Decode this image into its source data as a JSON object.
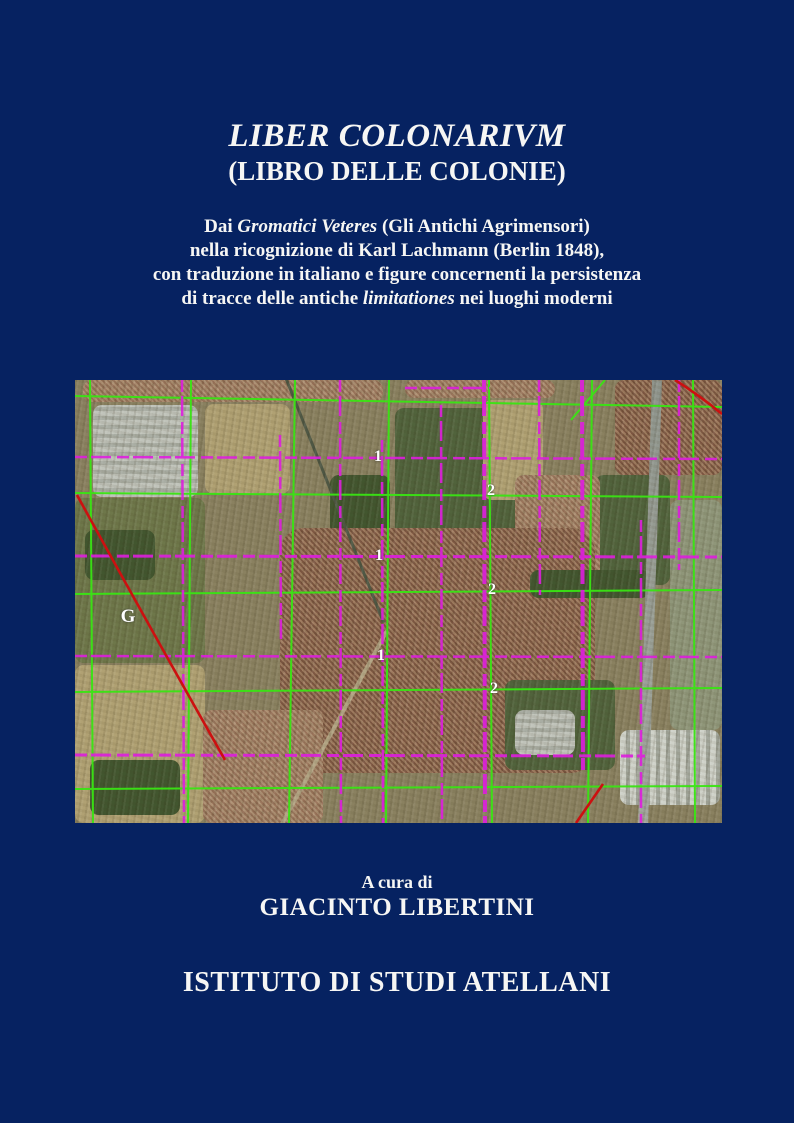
{
  "cover": {
    "background_color": "#062261",
    "text_color": "#f6f6f4"
  },
  "title": {
    "main": "LIBER COLONARIVM",
    "sub": "(LIBRO DELLE COLONIE)"
  },
  "subtitle": {
    "line1_pre": "Dai ",
    "line1_italic": "Gromatici Veteres",
    "line1_post": " (Gli Antichi Agrimensori)",
    "line2": "nella ricognizione di Karl Lachmann (Berlin 1848),",
    "line3": "con traduzione in italiano e figure concernenti la persistenza",
    "line4_pre": "di tracce delle antiche ",
    "line4_italic": "limitationes",
    "line4_post": " nei luoghi moderni"
  },
  "map_figure": {
    "grid_colors": {
      "primary_grid_green": "#39e513",
      "secondary_grid_magenta": "#de1ede",
      "highlight_red": "#cc1010",
      "label_color": "#ffffff"
    },
    "labels": [
      {
        "text": "G"
      },
      {
        "text": "1"
      },
      {
        "text": "1"
      },
      {
        "text": "1"
      },
      {
        "text": "2"
      },
      {
        "text": "2"
      },
      {
        "text": "2"
      }
    ]
  },
  "credits": {
    "byline": "A cura di",
    "editor": "GIACINTO LIBERTINI"
  },
  "publisher": {
    "name": "ISTITUTO DI STUDI ATELLANI"
  }
}
